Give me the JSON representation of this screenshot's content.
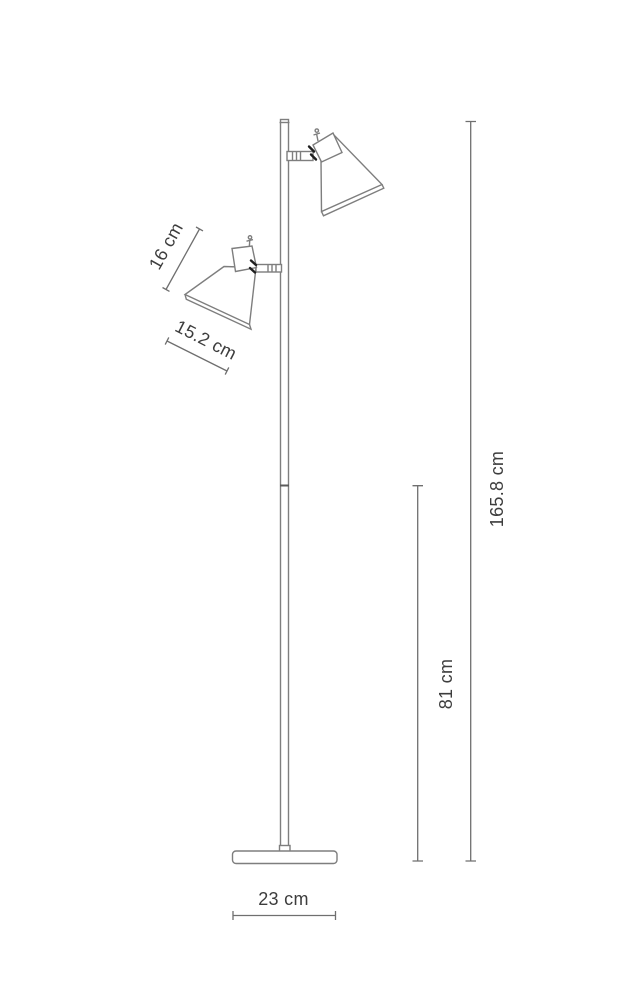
{
  "colors": {
    "background": "#ffffff",
    "outline": "#7e7e7e",
    "dimension_line": "#6f6f6f",
    "label_text": "#3d3d3d",
    "detail_dark": "#1f1f1f"
  },
  "dimensions": {
    "shade_height": {
      "label": "16 cm"
    },
    "shade_width": {
      "label": "15.2 cm"
    },
    "total_height": {
      "label": "165.8 cm"
    },
    "pole_to_floor": {
      "label": "81 cm"
    },
    "base_width": {
      "label": "23 cm"
    }
  }
}
